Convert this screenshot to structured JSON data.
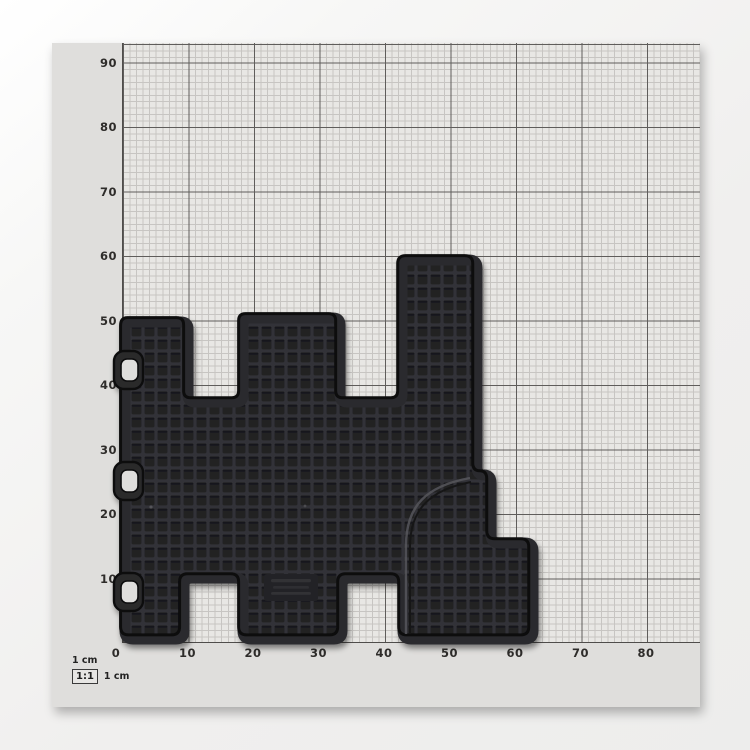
{
  "ruler": {
    "unit_top_label": "1 cm",
    "scale_badge": "1:1",
    "unit_side_label": "1 cm",
    "y_tick_labels": [
      "90",
      "80",
      "70",
      "60",
      "50",
      "40",
      "30",
      "20",
      "10"
    ],
    "x_tick_labels": [
      "0",
      "10",
      "20",
      "30",
      "40",
      "50",
      "60",
      "70",
      "80"
    ]
  },
  "paper": {
    "sheet_color": "#dfdedc",
    "grid_fine_color": "#c7c5c2",
    "grid_major_color": "#5f5d5b"
  },
  "mat": {
    "base_color": "#202023",
    "rib_color": "#333337",
    "rim_color": "#2b2b2e",
    "edge_color": "#0e0e10",
    "hook_count": 3,
    "approx_width_cm": 64,
    "approx_height_cm": 59
  }
}
